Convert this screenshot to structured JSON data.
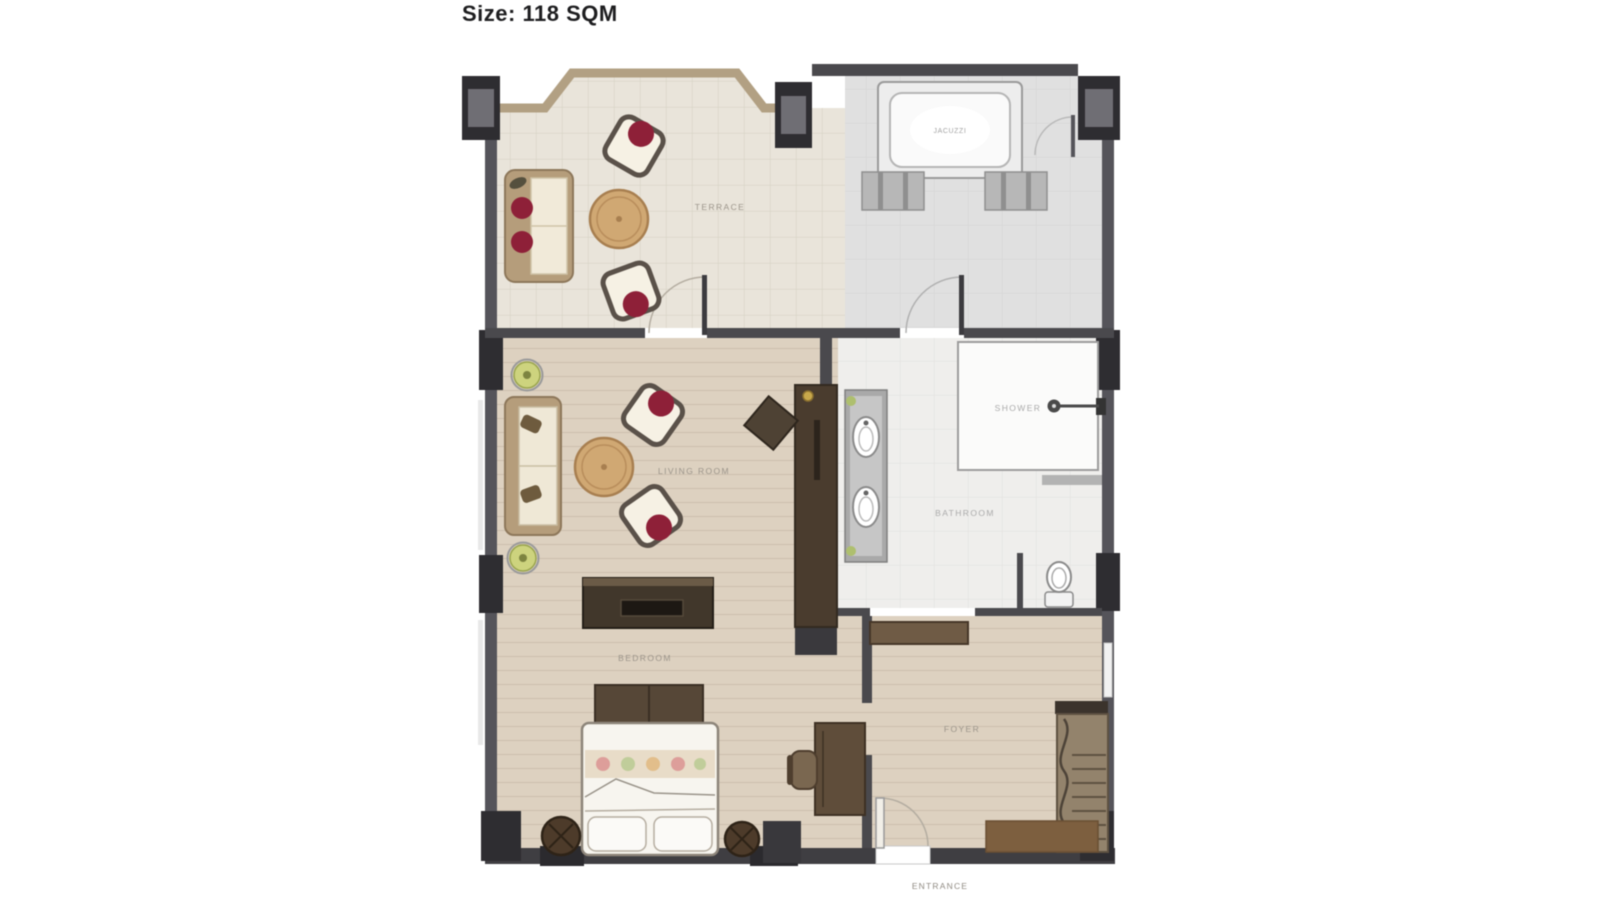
{
  "title": "Size: 118 SQM",
  "plan": {
    "size_sqm": "118",
    "labels": {
      "terrace": "TERRACE",
      "jacuzzi": "JACUZZI",
      "living_room": "LIVING ROOM",
      "bathroom": "BATHROOM",
      "shower": "SHOWER",
      "bedroom": "BEDROOM",
      "foyer": "FOYER",
      "entrance": "ENTRANCE"
    },
    "colors": {
      "wall": "#4a494d",
      "pillar": "#2e2d31",
      "bay_window_trim": "#b2a083",
      "terrace_floor": "#e9e4da",
      "jacuzzi_floor": "#e0e0e0",
      "wood_floor": "#ddd1c0",
      "bathroom_floor": "#efeeec",
      "dark_wood": "#41372b",
      "mid_wood": "#8a7a64",
      "table_wood": "#d0a873",
      "cushion_red": "#8e2038",
      "plant_green": "#cdd37e",
      "label_text": "#9b948a"
    }
  }
}
